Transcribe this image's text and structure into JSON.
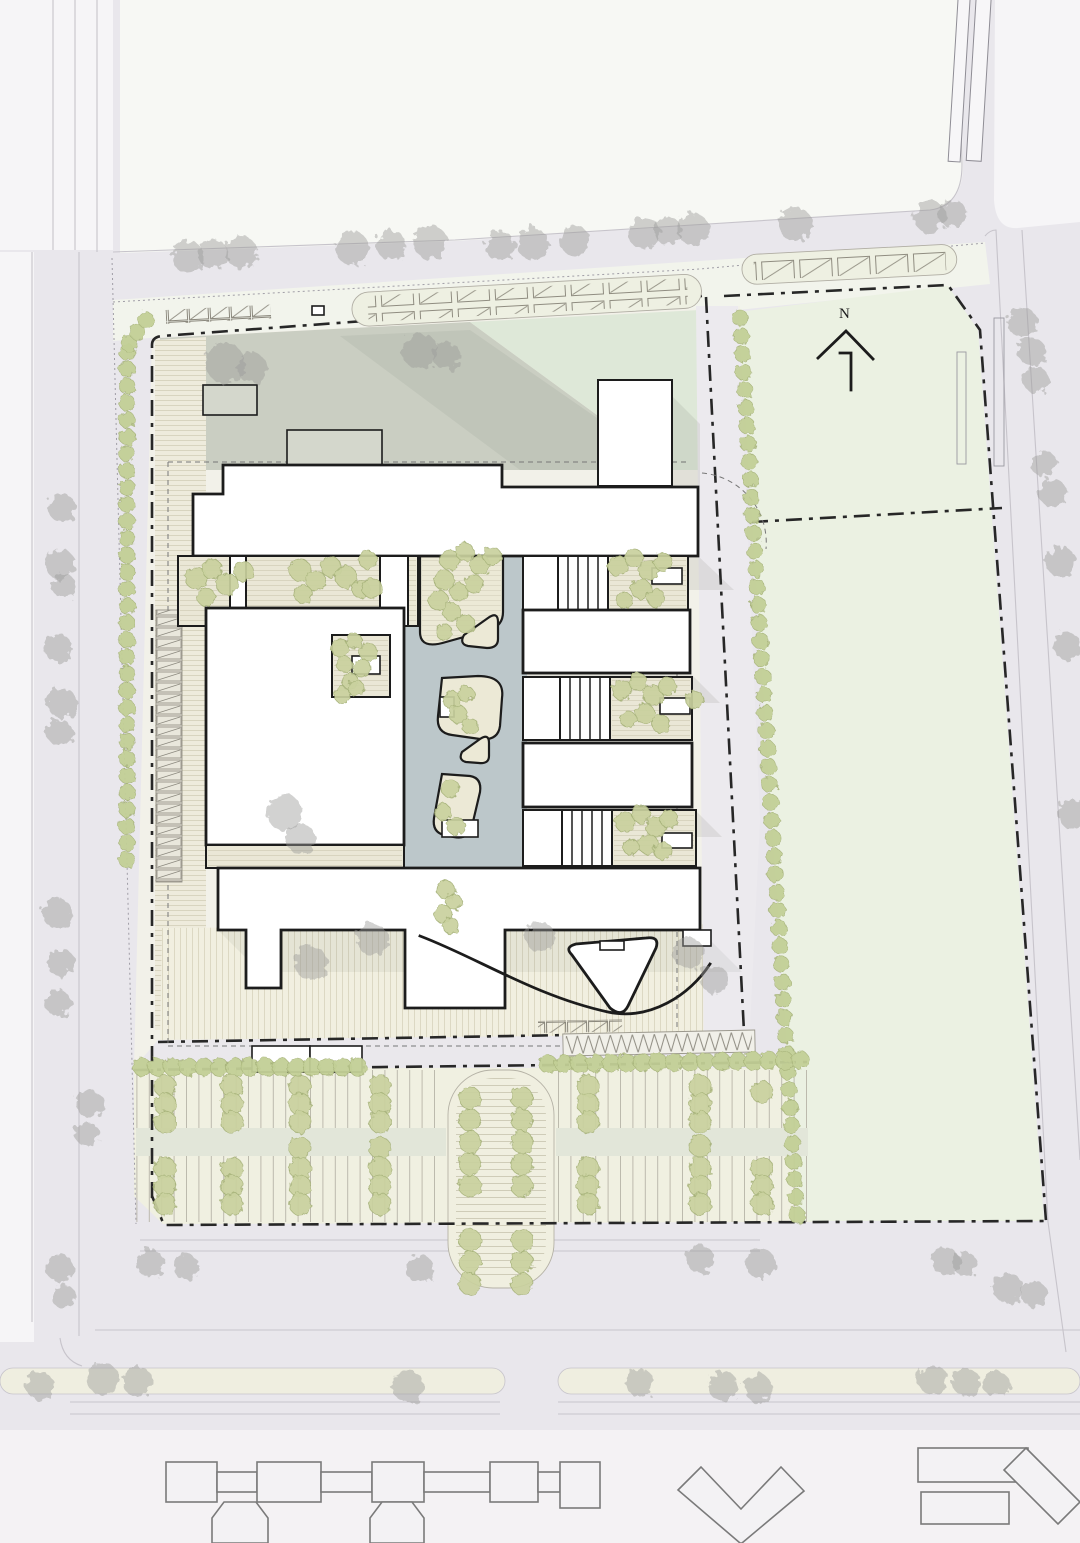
{
  "meta": {
    "drawing_type": "architectural site plan",
    "sheet": "master plan"
  },
  "north_arrow": {
    "label": "N"
  },
  "colors": {
    "road": "#e9e7ec",
    "roadLine": "#c7c4cb",
    "blockWhite": "#f6f5f7",
    "blockTop": "#f7f8f4",
    "lawn": "#ebf1e2",
    "lawnStrip": "#f2f4ec",
    "siteCream": "#f2f1e9",
    "parkingBg": "#f0f0e1",
    "grayZone": "#cacec2",
    "greenZone": "#dee8d8",
    "water": "#bcc7ca",
    "island": "#ece9d6",
    "buildingFill": "#ffffff",
    "buildingLine": "#1c1c1c",
    "garden": "#eae7d6",
    "shed": "#d4d7cc",
    "treeGreen": "#c9d19e",
    "treeGreenEdge": "#a4b077",
    "hedgeGreen": "#c2cf96",
    "treeGray": "#9b9b99",
    "boundary": "#272727",
    "shadow": "#4a4f48",
    "neighborFill": "#f3f2f4",
    "neighborLine": "#7a7a7a",
    "median": "#efeee0",
    "aisle": "#e2e6d9",
    "plazaFill": "#f1efe0",
    "stripeBand": "#eeebdc"
  },
  "trees": {
    "gray": [
      [
        188,
        257,
        16
      ],
      [
        213,
        254,
        15
      ],
      [
        241,
        252,
        16
      ],
      [
        352,
        248,
        17
      ],
      [
        391,
        245,
        15
      ],
      [
        430,
        242,
        17
      ],
      [
        500,
        246,
        15
      ],
      [
        533,
        244,
        16
      ],
      [
        575,
        241,
        15
      ],
      [
        644,
        233,
        16
      ],
      [
        668,
        231,
        14
      ],
      [
        693,
        229,
        16
      ],
      [
        795,
        224,
        17
      ],
      [
        930,
        217,
        16
      ],
      [
        953,
        214,
        14
      ],
      [
        225,
        363,
        20
      ],
      [
        252,
        368,
        15
      ],
      [
        420,
        351,
        18
      ],
      [
        447,
        356,
        14
      ],
      [
        1022,
        322,
        15
      ],
      [
        1032,
        352,
        14
      ],
      [
        1036,
        380,
        13
      ],
      [
        1044,
        464,
        13
      ],
      [
        1053,
        493,
        14
      ],
      [
        1061,
        562,
        15
      ],
      [
        1067,
        646,
        14
      ],
      [
        1073,
        814,
        15
      ],
      [
        62,
        508,
        14
      ],
      [
        60,
        564,
        15
      ],
      [
        64,
        586,
        12
      ],
      [
        58,
        648,
        14
      ],
      [
        62,
        703,
        15
      ],
      [
        60,
        733,
        13
      ],
      [
        57,
        913,
        15
      ],
      [
        61,
        963,
        14
      ],
      [
        58,
        1003,
        13
      ],
      [
        90,
        1104,
        14
      ],
      [
        87,
        1134,
        12
      ],
      [
        60,
        1268,
        14
      ],
      [
        63,
        1296,
        12
      ],
      [
        40,
        1386,
        14
      ],
      [
        103,
        1379,
        16
      ],
      [
        137,
        1381,
        15
      ],
      [
        408,
        1386,
        16
      ],
      [
        640,
        1383,
        14
      ],
      [
        723,
        1386,
        15
      ],
      [
        758,
        1388,
        14
      ],
      [
        933,
        1380,
        15
      ],
      [
        966,
        1382,
        14
      ],
      [
        996,
        1384,
        13
      ],
      [
        285,
        813,
        18
      ],
      [
        301,
        839,
        15
      ],
      [
        311,
        963,
        17
      ],
      [
        372,
        939,
        16
      ],
      [
        540,
        937,
        15
      ],
      [
        688,
        953,
        16
      ],
      [
        714,
        979,
        14
      ],
      [
        150,
        1263,
        14
      ],
      [
        186,
        1267,
        13
      ],
      [
        420,
        1269,
        14
      ],
      [
        700,
        1259,
        14
      ],
      [
        760,
        1263,
        15
      ],
      [
        945,
        1261,
        14
      ],
      [
        965,
        1264,
        12
      ],
      [
        1008,
        1288,
        15
      ],
      [
        1034,
        1294,
        13
      ]
    ],
    "green": [
      [
        196,
        578,
        11
      ],
      [
        212,
        569,
        10
      ],
      [
        227,
        584,
        11
      ],
      [
        206,
        597,
        9
      ],
      [
        244,
        572,
        10
      ],
      [
        300,
        570,
        11
      ],
      [
        316,
        581,
        10
      ],
      [
        331,
        567,
        10
      ],
      [
        346,
        577,
        11
      ],
      [
        361,
        589,
        9
      ],
      [
        303,
        594,
        9
      ],
      [
        368,
        560,
        9
      ],
      [
        372,
        588,
        10
      ],
      [
        450,
        560,
        10
      ],
      [
        465,
        552,
        9
      ],
      [
        480,
        565,
        10
      ],
      [
        492,
        556,
        9
      ],
      [
        444,
        580,
        10
      ],
      [
        459,
        592,
        9
      ],
      [
        474,
        584,
        9
      ],
      [
        438,
        600,
        10
      ],
      [
        452,
        612,
        9
      ],
      [
        466,
        624,
        9
      ],
      [
        444,
        632,
        8
      ],
      [
        618,
        566,
        10
      ],
      [
        634,
        558,
        9
      ],
      [
        649,
        571,
        10
      ],
      [
        663,
        562,
        9
      ],
      [
        641,
        589,
        10
      ],
      [
        656,
        598,
        9
      ],
      [
        624,
        600,
        8
      ],
      [
        340,
        648,
        9
      ],
      [
        354,
        641,
        8
      ],
      [
        368,
        652,
        9
      ],
      [
        344,
        664,
        8
      ],
      [
        362,
        668,
        9
      ],
      [
        350,
        681,
        8
      ],
      [
        342,
        695,
        8
      ],
      [
        356,
        688,
        8
      ],
      [
        452,
        700,
        9
      ],
      [
        466,
        694,
        8
      ],
      [
        458,
        714,
        9
      ],
      [
        470,
        726,
        8
      ],
      [
        450,
        788,
        9
      ],
      [
        443,
        812,
        8
      ],
      [
        456,
        826,
        9
      ],
      [
        446,
        890,
        9
      ],
      [
        454,
        902,
        8
      ],
      [
        443,
        914,
        9
      ],
      [
        451,
        926,
        8
      ],
      [
        622,
        690,
        10
      ],
      [
        638,
        682,
        9
      ],
      [
        653,
        695,
        10
      ],
      [
        667,
        686,
        9
      ],
      [
        645,
        714,
        10
      ],
      [
        661,
        724,
        9
      ],
      [
        628,
        719,
        8
      ],
      [
        695,
        700,
        9
      ],
      [
        625,
        822,
        10
      ],
      [
        641,
        814,
        9
      ],
      [
        656,
        827,
        10
      ],
      [
        669,
        819,
        9
      ],
      [
        648,
        844,
        10
      ],
      [
        663,
        851,
        9
      ],
      [
        631,
        847,
        8
      ]
    ]
  },
  "hedges": [
    {
      "x1": 127,
      "y1": 352,
      "x2": 127,
      "y2": 860,
      "step": 17,
      "r": 8
    },
    {
      "x1": 129,
      "y1": 344,
      "x2": 146,
      "y2": 320,
      "step": 13,
      "r": 8
    },
    {
      "x1": 740,
      "y1": 318,
      "x2": 797,
      "y2": 1215,
      "step": 18,
      "r": 8
    },
    {
      "x1": 142,
      "y1": 1067,
      "x2": 358,
      "y2": 1067,
      "step": 16,
      "r": 9
    },
    {
      "x1": 548,
      "y1": 1064,
      "x2": 800,
      "y2": 1060,
      "step": 16,
      "r": 9
    }
  ],
  "parking": {
    "tree_columns": [
      {
        "x": 165,
        "ys": [
          1086,
          1104,
          1122,
          1168,
          1186,
          1204
        ]
      },
      {
        "x": 232,
        "ys": [
          1086,
          1104,
          1122,
          1168,
          1186,
          1204
        ]
      },
      {
        "x": 300,
        "ys": [
          1086,
          1104,
          1122,
          1148,
          1168,
          1186,
          1204
        ]
      },
      {
        "x": 380,
        "ys": [
          1086,
          1104,
          1122,
          1148,
          1168,
          1186,
          1204
        ]
      },
      {
        "x": 588,
        "ys": [
          1086,
          1104,
          1122,
          1168,
          1186,
          1204
        ]
      },
      {
        "x": 700,
        "ys": [
          1086,
          1104,
          1122,
          1146,
          1168,
          1186,
          1204
        ]
      },
      {
        "x": 762,
        "ys": [
          1092,
          1168,
          1186,
          1204
        ]
      },
      {
        "x": 470,
        "ys": [
          1098,
          1120,
          1142,
          1164,
          1186,
          1240,
          1262,
          1284
        ]
      },
      {
        "x": 522,
        "ys": [
          1098,
          1120,
          1142,
          1164,
          1186,
          1240,
          1262,
          1284
        ]
      }
    ]
  }
}
